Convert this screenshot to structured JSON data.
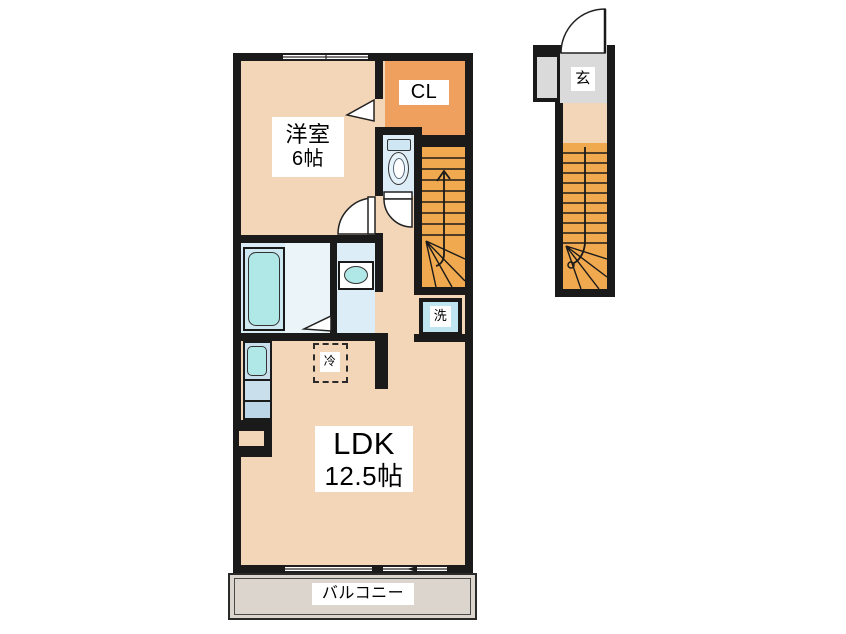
{
  "floorplan": {
    "rooms": {
      "bedroom": {
        "name": "洋室",
        "area": "6帖"
      },
      "closet": {
        "label": "CL"
      },
      "ldk": {
        "name": "LDK",
        "area": "12.5帖"
      },
      "balcony": {
        "label": "バルコニー"
      },
      "entrance": {
        "label": "玄"
      }
    },
    "fixtures": {
      "washer": {
        "label": "洗"
      },
      "refrigerator": {
        "label": "冷"
      }
    },
    "colors": {
      "wall": "#1a1a1a",
      "floor": "#F3D6B8",
      "closet": "#EFA05E",
      "stairs": "#F0A94E",
      "wet": "#DDEDF7",
      "bath": "#D9EBF4",
      "shower": "#EAF4F9",
      "fixture": "#AFE8E6",
      "counter": "#C9DFEB",
      "washerbox": "#BFE5F0",
      "balcony": "#DBD5CD",
      "entrance": "#DADADA"
    }
  }
}
